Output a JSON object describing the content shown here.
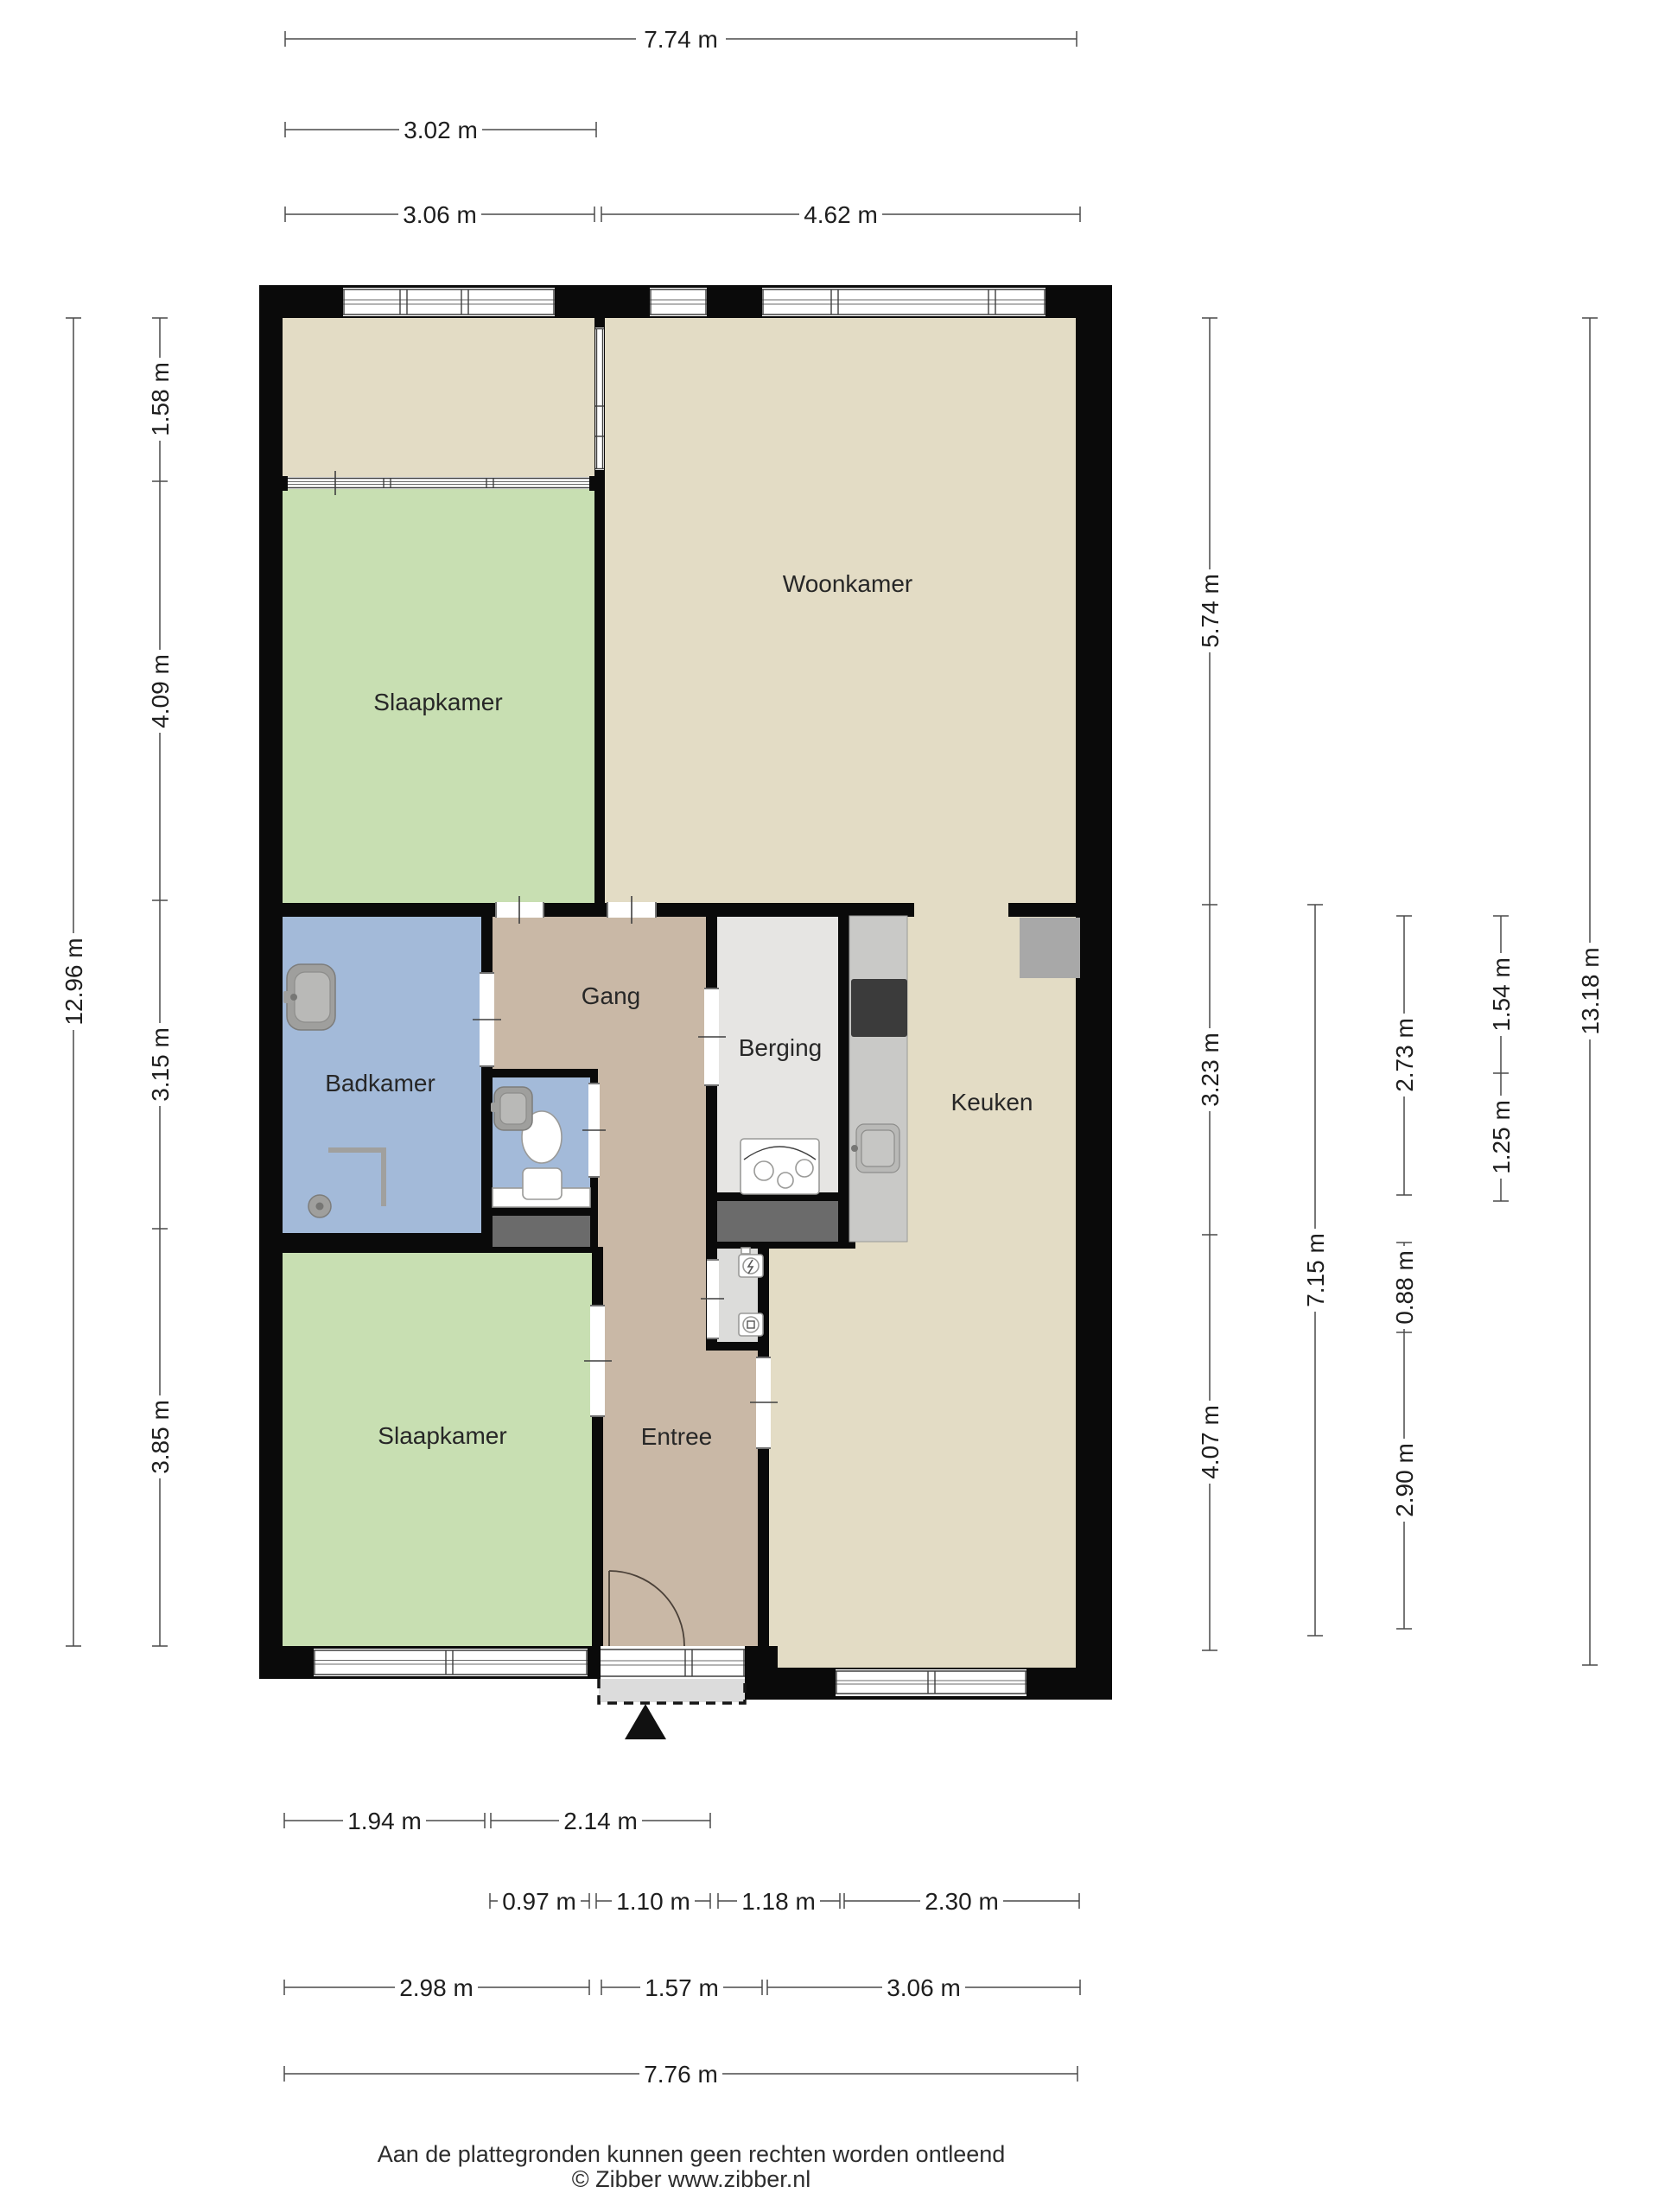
{
  "plan": {
    "type": "floorplan",
    "language": "nl"
  },
  "rooms": {
    "woonkamer": "Woonkamer",
    "slaapkamer_top": "Slaapkamer",
    "slaapkamer_bottom": "Slaapkamer",
    "badkamer": "Badkamer",
    "gang": "Gang",
    "berging": "Berging",
    "keuken": "Keuken",
    "entree": "Entree"
  },
  "fixtures": [
    "bathtub-basin",
    "shower",
    "toilet",
    "wc-basin",
    "washing-machine",
    "kitchen-counter",
    "cooktop",
    "sink",
    "fridge",
    "meter-cabinet",
    "entrance-door"
  ],
  "dimensions": {
    "top": [
      "7.74 m",
      "3.02 m",
      "3.06 m",
      "4.62 m"
    ],
    "left": [
      "12.96 m",
      "1.58 m",
      "4.09 m",
      "3.15 m",
      "3.85 m"
    ],
    "right": [
      "5.74 m",
      "3.23 m",
      "4.07 m",
      "7.15 m",
      "2.73 m",
      "0.88 m",
      "2.90 m",
      "1.54 m",
      "1.25 m",
      "13.18 m"
    ],
    "bottom": [
      "1.94 m",
      "2.14 m",
      "0.97 m",
      "1.10 m",
      "1.18 m",
      "2.30 m",
      "2.98 m",
      "1.57 m",
      "3.06 m",
      "7.76 m"
    ]
  },
  "footer": {
    "disclaimer": "Aan de plattegronden kunnen geen rechten worden ontleend",
    "copyright": "© Zibber www.zibber.nl"
  },
  "colors": {
    "background": "#ffffff",
    "wall": "#0a0a0a",
    "floor_beige": "#e3dcc5",
    "floor_green": "#c8dfb2",
    "floor_blue": "#a3bad9",
    "floor_tan": "#c9b8a6",
    "floor_berging": "#e6e5e3",
    "floor_meter": "#dcdcda",
    "shaft_gray": "#6b6b6b",
    "counter_gray": "#c9c9c7",
    "appliance_gray": "#a8a8a8",
    "cooktop_dark": "#3b3b3b",
    "porch_gray": "#dcdcdc",
    "fixture_gray": "#9f9f9d",
    "dim_line": "#4a4a4a",
    "text_dark": "#1e1e1e"
  }
}
